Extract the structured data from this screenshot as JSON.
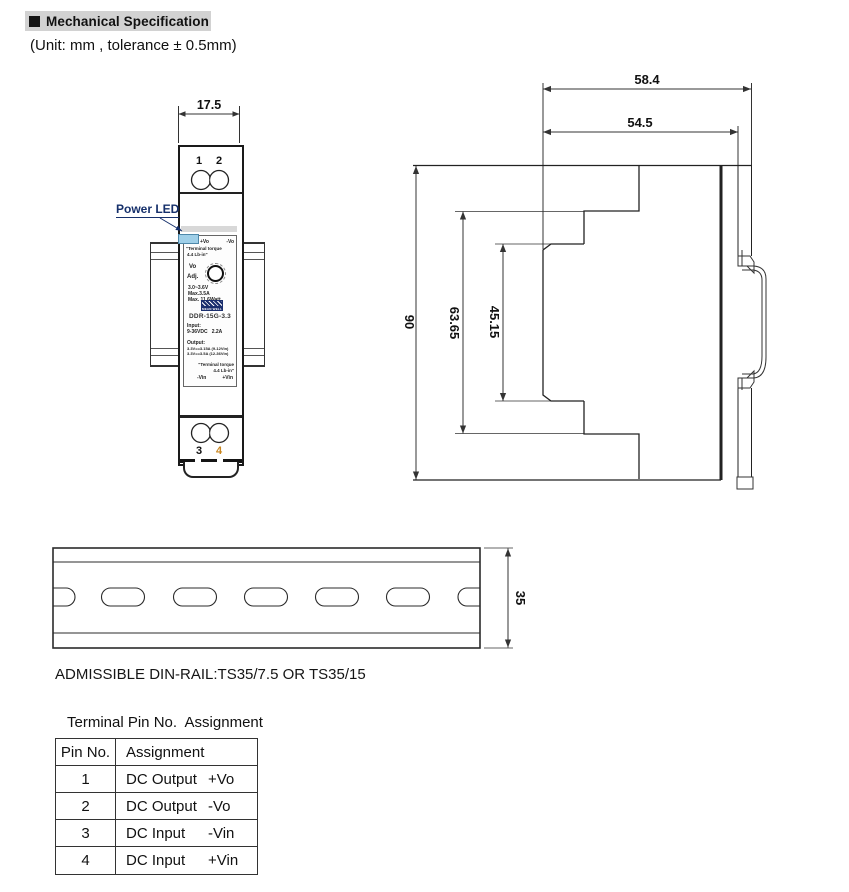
{
  "header": {
    "title": "Mechanical Specification"
  },
  "unit_note": "(Unit: mm , tolerance ± 0.5mm)",
  "front_view": {
    "dim_width": "17.5",
    "power_led_label": "Power LED",
    "terminal_1": "1",
    "terminal_2": "2",
    "terminal_3": "3",
    "terminal_4": "4",
    "label": {
      "vo_plus": "+Vo",
      "vo_minus": "-Vo",
      "torque_top_1": "\"Terminal torque",
      "torque_top_2": "4.4 Lb-in\"",
      "vo": "Vo",
      "adj": "Adj.",
      "volt_range": "3.0~3.6V",
      "max_current": "Max.3.5A",
      "max_watt": "Max. 11.6Watt",
      "brand": "MEAN WELL",
      "model": "DDR-15G-3.3",
      "input_label": "Input:",
      "input_spec": "9-36VDC   2.2A",
      "output_label": "Output:",
      "output_spec_1": "3.3V==3.15A (9-12Vin)",
      "output_spec_2": "3.3V==3.5A (12-36Vin)",
      "torque_bottom_1": "\"Terminal torque",
      "torque_bottom_2": "4.4 Lb-in\"",
      "vin_minus": "-Vin",
      "vin_plus": "+Vin"
    }
  },
  "side_view": {
    "dim_depth_total": "58.4",
    "dim_depth_body": "54.5",
    "dim_height_total": "90",
    "dim_height_mid": "63.65",
    "dim_height_front": "45.15"
  },
  "rail_view": {
    "dim_rail_height": "35",
    "note": "ADMISSIBLE DIN-RAIL:TS35/7.5 OR TS35/15"
  },
  "pin_table": {
    "title": "Terminal Pin No.  Assignment",
    "header_pin": "Pin No.",
    "header_assignment": "Assignment",
    "rows": [
      {
        "pin": "1",
        "device": "DC Output",
        "polarity": "+Vo"
      },
      {
        "pin": "2",
        "device": "DC Output",
        "polarity": "-Vo"
      },
      {
        "pin": "3",
        "device": "DC Input",
        "polarity": "-Vin"
      },
      {
        "pin": "4",
        "device": "DC Input",
        "polarity": "+Vin"
      }
    ]
  },
  "colors": {
    "led_blue": "#9fcfe8",
    "pin4_orange": "#c9861f",
    "header_bg": "#d2d2d2"
  }
}
